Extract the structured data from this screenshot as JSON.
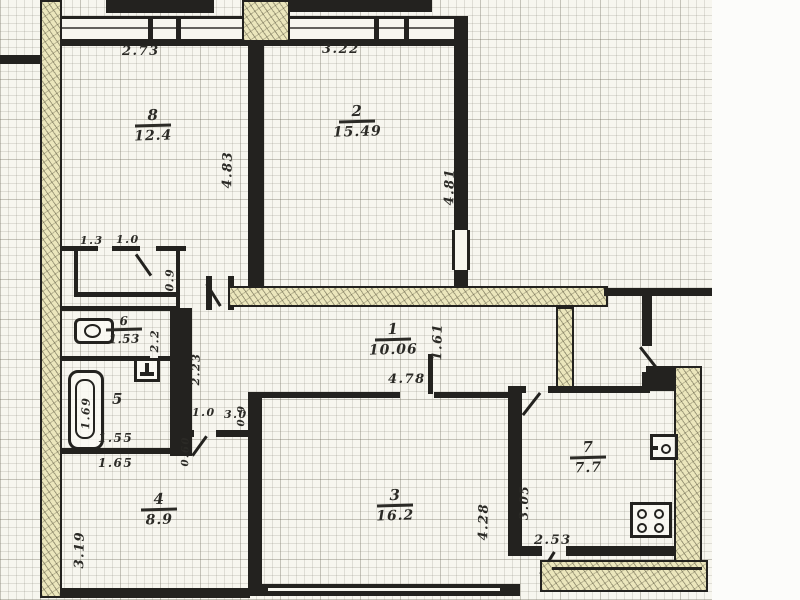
{
  "plan": {
    "type": "apartment-floor-plan",
    "colors": {
      "paper": "#f7f6ef",
      "grid": "#c6c3b5",
      "wall": "#23221f",
      "hatch_fill": "#ebe6bc",
      "ink": "#2b2a26"
    }
  },
  "rooms": {
    "r1": {
      "number": "1",
      "area": "10.06"
    },
    "r2": {
      "number": "2",
      "area": "15.49"
    },
    "r3": {
      "number": "3",
      "area": "16.2"
    },
    "r4": {
      "number": "4",
      "area": "8.9"
    },
    "r5": {
      "number": "5"
    },
    "r6": {
      "number": "6",
      "area": "1.53"
    },
    "r7": {
      "number": "7",
      "area": "7.7"
    },
    "r8": {
      "number": "8",
      "area": "12.4"
    }
  },
  "dims": {
    "d2_73": "2.73",
    "d3_22": "3.22",
    "d4_83": "4.83",
    "d4_81": "4.81",
    "d1_3": "1.3",
    "d1_0_closet": "1.0",
    "d0_9_closet": "0.9",
    "d4_78": "4.78",
    "d1_61": "1.61",
    "d2_2": "2.2",
    "d2_23": "2.23",
    "d1_69": "1.69",
    "d1_55": "1.55",
    "d1_65": "1.65",
    "d1_0_pass": "1.0",
    "d3_0_pass": "3.0",
    "d0_60": "0.60",
    "d0_9_pass": "0.9",
    "d3_19": "3.19",
    "d4_28": "4.28",
    "d3_05": "3.05",
    "d2_53": "2.53"
  }
}
